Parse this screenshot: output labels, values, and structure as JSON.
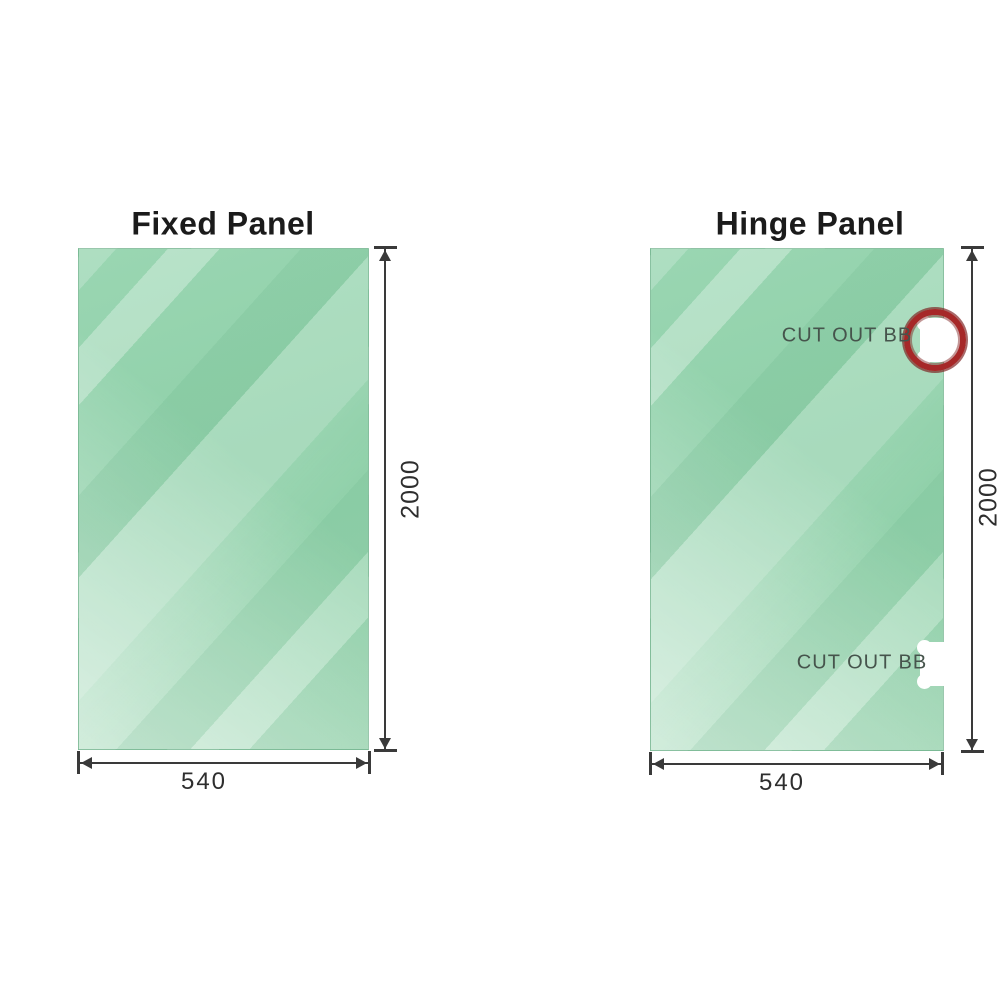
{
  "page": {
    "background": "#ffffff"
  },
  "panels": {
    "fixed": {
      "title": "Fixed Panel",
      "width_label": "540",
      "height_label": "2000"
    },
    "hinge": {
      "title": "Hinge Panel",
      "width_label": "540",
      "height_label": "2000",
      "cutouts": [
        {
          "label": "CUT OUT BB",
          "position": "top",
          "highlighted": true
        },
        {
          "label": "CUT OUT BB",
          "position": "bottom",
          "highlighted": false
        }
      ]
    }
  },
  "colors": {
    "glass_green": "#9ad6b2",
    "dimension_line": "#3a3a3a",
    "highlight_ring_red": "#a62828",
    "cutout_label_text": "#46544c",
    "title_text": "#1b1b1b"
  }
}
